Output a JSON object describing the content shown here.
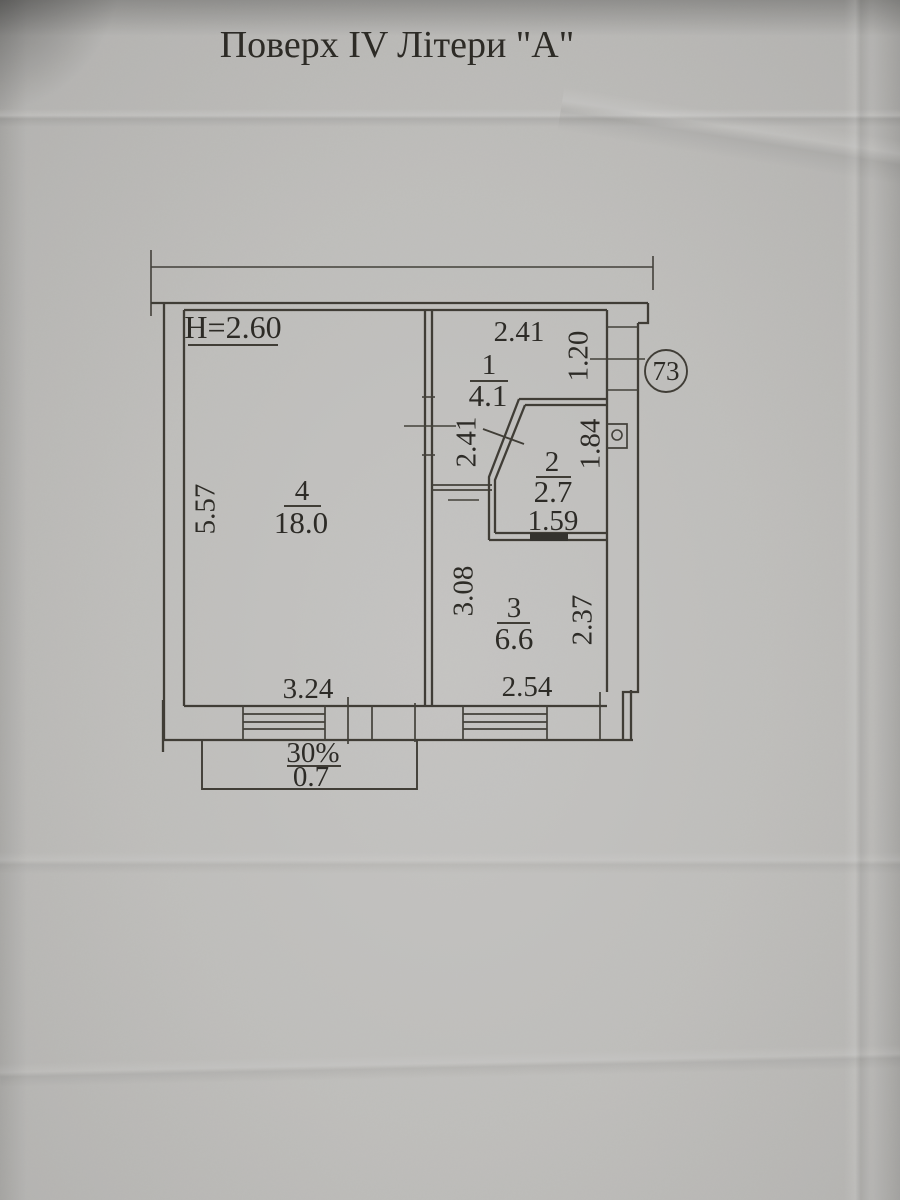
{
  "title": "Поверх IV Літери \"А\"",
  "plan": {
    "ceiling_height": "H=2.60",
    "unit_number": "73",
    "rooms": [
      {
        "number": "1",
        "area": "4.1"
      },
      {
        "number": "2",
        "area": "2.7"
      },
      {
        "number": "3",
        "area": "6.6"
      },
      {
        "number": "4",
        "area": "18.0"
      }
    ],
    "dimensions": {
      "room1_width_top": "2.41",
      "room1_right": "1.20",
      "room1_left": "2.41",
      "room2_right": "1.84",
      "room2_bottom": "1.59",
      "room3_left": "3.08",
      "room3_right": "2.37",
      "room3_bottom": "2.54",
      "room4_bottom": "3.24",
      "room4_left": "5.57"
    },
    "balcony": {
      "coefficient": "30%",
      "area": "0.7"
    }
  }
}
